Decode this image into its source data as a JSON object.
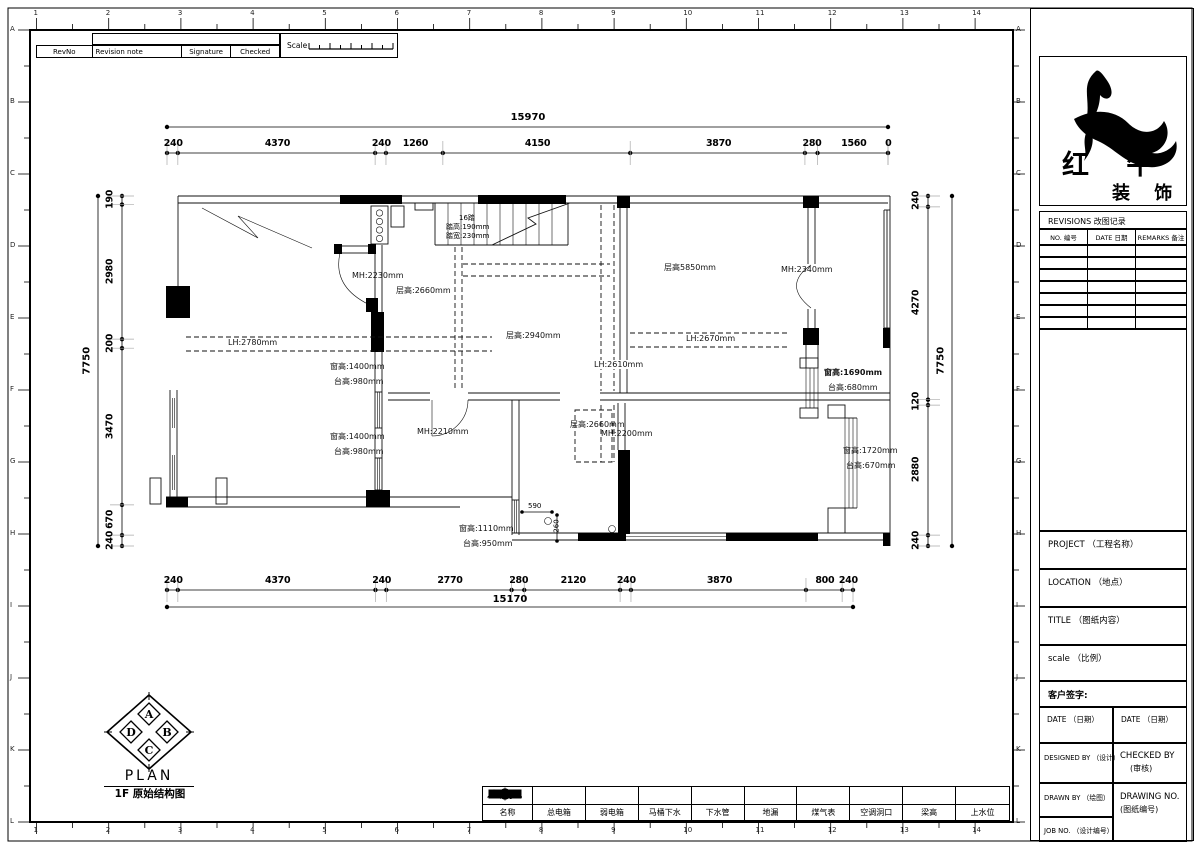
{
  "page": {
    "grid_numbers": [
      "1",
      "2",
      "3",
      "4",
      "5",
      "6",
      "7",
      "8",
      "9",
      "10",
      "11",
      "12",
      "13",
      "14"
    ],
    "grid_letters": [
      "A",
      "B",
      "C",
      "D",
      "E",
      "F",
      "G",
      "H",
      "I",
      "J",
      "K",
      "L"
    ],
    "line_color": "#000000",
    "background": "#ffffff"
  },
  "rev_table": {
    "headers": [
      "RevNo",
      "Revision note",
      "Signature",
      "Checked"
    ],
    "scale_label": "Scale"
  },
  "dims": {
    "top": {
      "total": "15970",
      "segments": [
        "240",
        "4370",
        "240",
        "1260",
        "4150",
        "3870",
        "280",
        "1560",
        "0"
      ]
    },
    "bottom": {
      "total": "15170",
      "segments": [
        "240",
        "4370",
        "240",
        "2770",
        "280",
        "2120",
        "240",
        "3870",
        "800",
        "240"
      ]
    },
    "left": {
      "total": "7750",
      "segments": [
        "190",
        "2980",
        "200",
        "3470",
        "670",
        "240"
      ]
    },
    "right": {
      "total": "7750",
      "segments": [
        "240",
        "4270",
        "120",
        "2880",
        "240"
      ]
    },
    "inner": {
      "d590": "590",
      "d260": "260"
    }
  },
  "plan": {
    "stair": {
      "l1": "16踏",
      "l2": "踏高:190mm",
      "l3": "踏宽:230mm"
    },
    "labels": {
      "mh2230": "MH:2230mm",
      "ch2660a": "层高:2660mm",
      "ch2940": "层高:2940mm",
      "ch5850": "层高5850mm",
      "mh2340": "MH:2340mm",
      "lh2670": "LH:2670mm",
      "lh2780": "LH:2780mm",
      "lh2610": "LH:2610mm",
      "win1690": "窗高:1690mm",
      "sill680": "台高:680mm",
      "win1400a": "窗高:1400mm",
      "sill980a": "台高:980mm",
      "win1400b": "窗高:1400mm",
      "sill980b": "台高:980mm",
      "mh2210": "MH:2210mm",
      "ch2660b": "层高:2660mm",
      "mh2200": "MH:2200mm",
      "win1720": "窗高:1720mm",
      "sill670": "台高:670mm",
      "win1110": "窗高:1110mm",
      "sill950": "台高:950mm"
    }
  },
  "plan_title": {
    "compass": [
      "A",
      "B",
      "C",
      "D"
    ],
    "label": "PLAN",
    "subtitle": "1F 原始结构图"
  },
  "legend": {
    "symbol_header": "图示",
    "name_header": "名称",
    "items": [
      {
        "name": "总电箱",
        "icon": "main-electric-box-icon"
      },
      {
        "name": "弱电箱",
        "icon": "low-voltage-box-icon"
      },
      {
        "name": "马桶下水",
        "icon": "toilet-drain-icon"
      },
      {
        "name": "下水管",
        "icon": "drain-pipe-icon"
      },
      {
        "name": "地漏",
        "icon": "floor-drain-icon"
      },
      {
        "name": "煤气表",
        "icon": "gas-meter-icon"
      },
      {
        "name": "空调洞口",
        "icon": "ac-hole-icon"
      },
      {
        "name": "梁高",
        "icon": "beam-height-icon"
      },
      {
        "name": "上水位",
        "icon": "water-supply-icon"
      }
    ]
  },
  "title_block": {
    "company": "红 牛",
    "company_sub": "装 饰",
    "revisions_title": "REVISIONS 改图记录",
    "rev_cols": [
      "NO. 编号",
      "DATE 日期",
      "REMARKS 备注"
    ],
    "project": "PROJECT （工程名称）",
    "location": "LOCATION （地点）",
    "title": "TITLE （图纸内容）",
    "scale": "scale （比例）",
    "client_sign": "客户签字:",
    "date_l": "DATE （日期）",
    "date_r": "DATE （日期）",
    "designed_by": "DESIGNED BY （设计）",
    "checked_by_1": "CHECKED BY",
    "checked_by_2": "(审核)",
    "drawn_by": "DRAWN BY （绘图）",
    "drawing_no_1": "DRAWING NO.",
    "drawing_no_2": "(图纸编号)",
    "job_no": "JOB NO. （设计编号）"
  }
}
